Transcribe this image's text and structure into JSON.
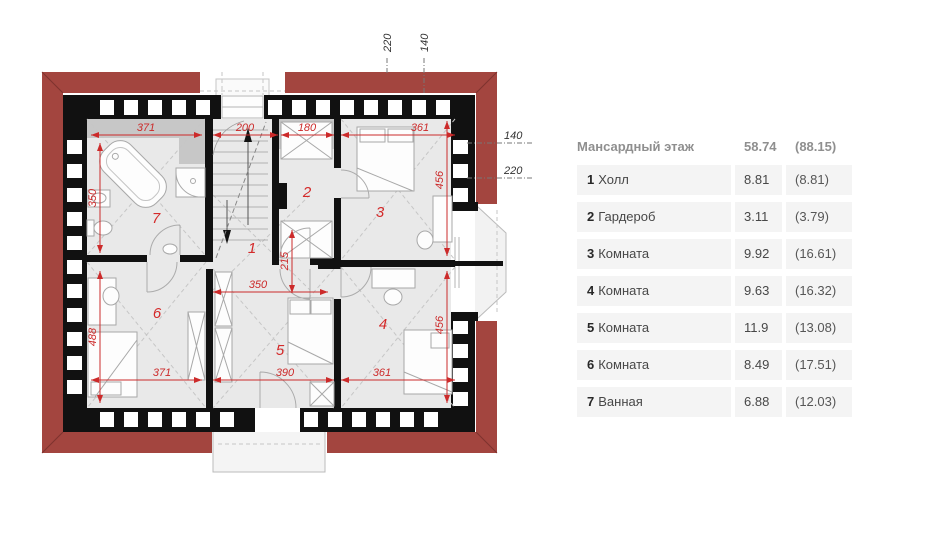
{
  "plan": {
    "floor_name": "Мансардный этаж",
    "room_numbers": {
      "r1": "1",
      "r2": "2",
      "r3": "3",
      "r4": "4",
      "r5": "5",
      "r6": "6",
      "r7": "7"
    },
    "dims_red": {
      "top_371": "371",
      "top_200": "200",
      "top_180": "180",
      "top_361": "361",
      "left_350": "350",
      "left_488": "488",
      "right_456_top": "456",
      "right_456_bottom": "456",
      "mid_215": "215",
      "mid_350": "350",
      "bottom_371": "371",
      "bottom_390": "390",
      "bottom_361": "361"
    },
    "dims_black": {
      "top_220": "220",
      "top_140": "140",
      "right_140": "140",
      "right_220": "220"
    },
    "colors": {
      "roof_red": "#a3453f",
      "dimension_red": "#cc2a2a",
      "wall_black": "#111111",
      "floor_gray": "#e9e9e9",
      "floor_dark_gray": "#c7c7c7",
      "table_row_bg": "#f4f4f4",
      "table_header_text": "#8f8f8f",
      "table_text": "#474747"
    }
  },
  "table": {
    "header": {
      "title": "Мансардный этаж",
      "area": "58.74",
      "area_total": "(88.15)"
    },
    "rows": [
      {
        "num": "1",
        "name": "Холл",
        "area": "8.81",
        "total": "(8.81)"
      },
      {
        "num": "2",
        "name": "Гардероб",
        "area": "3.11",
        "total": "(3.79)"
      },
      {
        "num": "3",
        "name": "Комната",
        "area": "9.92",
        "total": "(16.61)"
      },
      {
        "num": "4",
        "name": "Комната",
        "area": "9.63",
        "total": "(16.32)"
      },
      {
        "num": "5",
        "name": "Комната",
        "area": "11.9",
        "total": "(13.08)"
      },
      {
        "num": "6",
        "name": "Комната",
        "area": "8.49",
        "total": "(17.51)"
      },
      {
        "num": "7",
        "name": "Ванная",
        "area": "6.88",
        "total": "(12.03)"
      }
    ]
  }
}
